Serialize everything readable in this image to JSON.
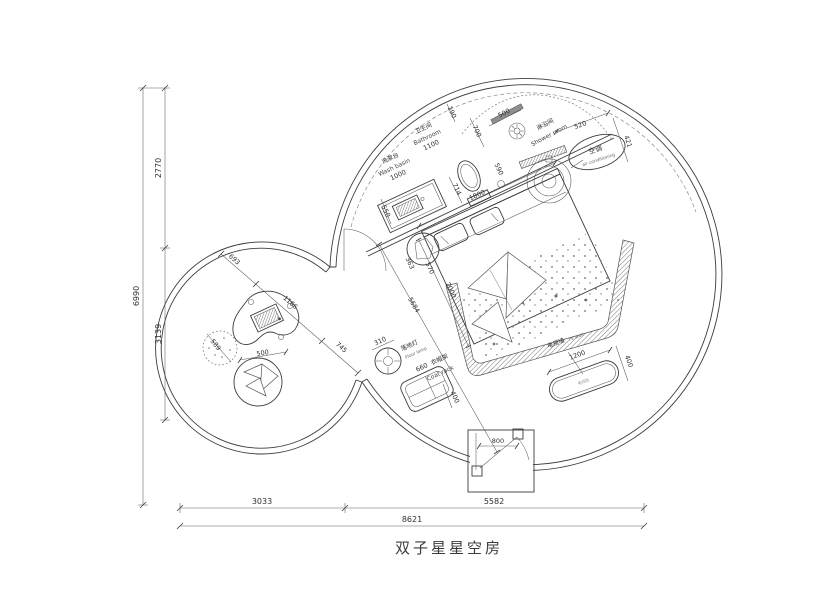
{
  "title": "双子星星空房",
  "colors": {
    "line": "#3c3c3c",
    "hatch": "#555555",
    "muted": "#8a8a8a"
  },
  "labels": {
    "bathroom_cn": "卫生间",
    "bathroom_en": "Bathroom",
    "shower_cn": "淋浴间",
    "shower_en": "Shower room",
    "basin_cn": "洗漱台",
    "basin_en": "Wash basin",
    "ac_cn": "空调",
    "ac_en": "air conditioning",
    "lamp_cn": "落地灯",
    "lamp_en": "Floor lamp",
    "rack_cn": "衣帽架",
    "rack_en": "Coat rack",
    "tv_cn": "电视墙",
    "tv_en": "TV wall",
    "tv_cabinet": "电视柜"
  },
  "dims": {
    "basin_width": "1000",
    "basin_depth": "550",
    "toilet_offset": "714",
    "bathroom_length": "1100",
    "partition": "700",
    "wall_gap": "190",
    "shower_opening": "590",
    "shower_door": "500",
    "ac_width": "520",
    "ac_depth": "421",
    "bed_width": "1800",
    "bed_length": "2000",
    "stool_a": "363",
    "stool_b": "570",
    "diagonal": "5684",
    "lamp": "310",
    "rack_width": "660",
    "rack_depth": "400",
    "tv_width": "1200",
    "tv_depth": "400",
    "door": "800",
    "lounge_a": "693",
    "lounge_b": "1166",
    "lounge_c": "745",
    "pouf": "589",
    "beanbag": "500",
    "left_top": "2770",
    "left_bottom": "3139",
    "left_total": "6990",
    "bottom_left": "3033",
    "bottom_right": "5582",
    "bottom_total": "8621"
  }
}
